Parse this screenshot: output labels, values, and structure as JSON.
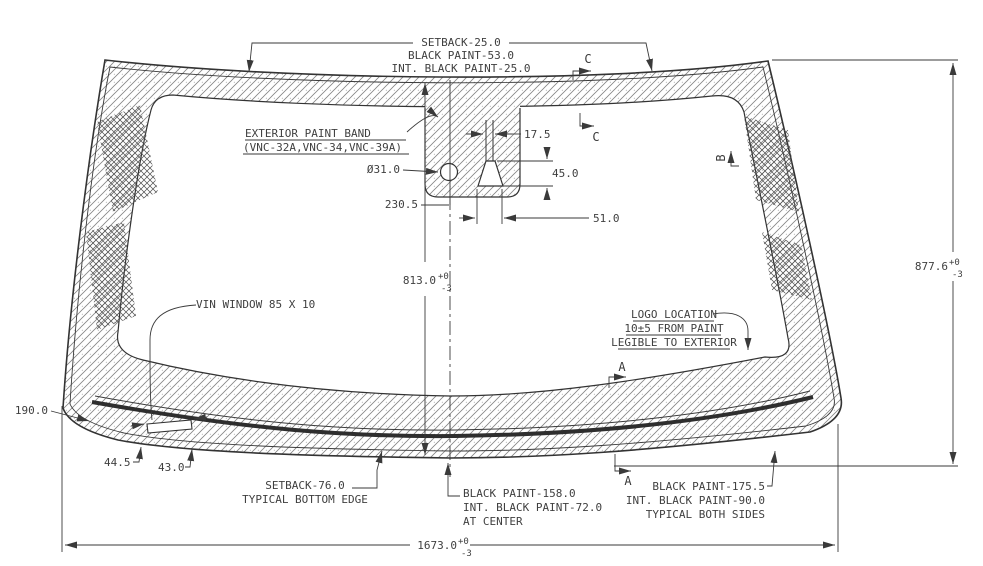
{
  "drawing": {
    "type": "windshield-glass-engineering-drawing",
    "labels": {
      "top_edge": [
        "SETBACK-25.0",
        "BLACK PAINT-53.0",
        "INT. BLACK PAINT-25.0"
      ],
      "paint_band": [
        "EXTERIOR PAINT BAND",
        "(VNC-32A,VNC-34,VNC-39A)"
      ],
      "vin_window": "VIN WINDOW 85 X 10",
      "logo": [
        "LOGO LOCATION",
        "10±5 FROM PAINT",
        "LEGIBLE TO EXTERIOR"
      ],
      "bottom_edge": [
        "SETBACK-76.0",
        "TYPICAL BOTTOM EDGE"
      ],
      "bottom_center": [
        "BLACK PAINT-158.0",
        "INT. BLACK PAINT-72.0",
        "AT CENTER"
      ],
      "bottom_sides": [
        "BLACK PAINT-175.5",
        "INT. BLACK PAINT-90.0",
        "TYPICAL BOTH SIDES"
      ]
    },
    "dims": {
      "overall_width": "1673.0",
      "overall_height": "877.6",
      "center_height": "813.0",
      "tol_plus": "+0",
      "tol_minus": "-3",
      "pad_offset": "230.5",
      "hole_dia": "Ø31.0",
      "bracket_top_width": "17.5",
      "bracket_height": "45.0",
      "bracket_base_width": "51.0",
      "vin_offset_left": "44.5",
      "vin_offset_right": "43.0",
      "corner_band": "190.0"
    },
    "sections": {
      "a": "A",
      "b": "B",
      "c": "C"
    },
    "colors": {
      "line": "#3a3a3a",
      "text": "#3f3f3f",
      "hatch": "#808080",
      "crosshatch": "#4d4d4d",
      "molding": "#2e2e2e",
      "background": "#ffffff"
    }
  }
}
